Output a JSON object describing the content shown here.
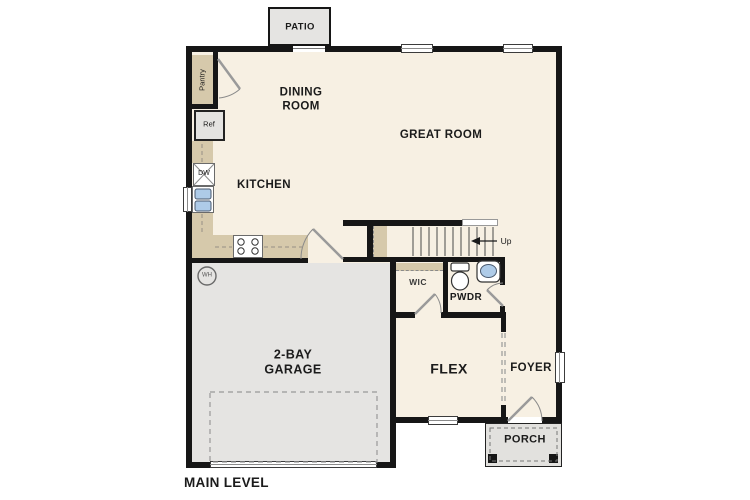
{
  "plan": {
    "title": "MAIN LEVEL",
    "rooms": {
      "patio": "PATIO",
      "dining_room": "DINING\nROOM",
      "great_room": "GREAT ROOM",
      "kitchen": "KITCHEN",
      "garage": "2-BAY\nGARAGE",
      "flex": "FLEX",
      "foyer": "FOYER",
      "porch": "PORCH",
      "wic": "WIC",
      "powder": "PWDR"
    },
    "fixtures": {
      "pantry": "Pantry",
      "refrigerator": "Ref",
      "dishwasher": "DW",
      "water_heater": "WH",
      "stairs_direction": "Up"
    },
    "colors": {
      "floor": "#f7f0e3",
      "counter": "#d6c9ab",
      "garage": "#e5e4e2",
      "porch": "#e2e1de",
      "wall": "#161616",
      "sink": "#aecbe8",
      "text": "#1b1b1b"
    }
  }
}
